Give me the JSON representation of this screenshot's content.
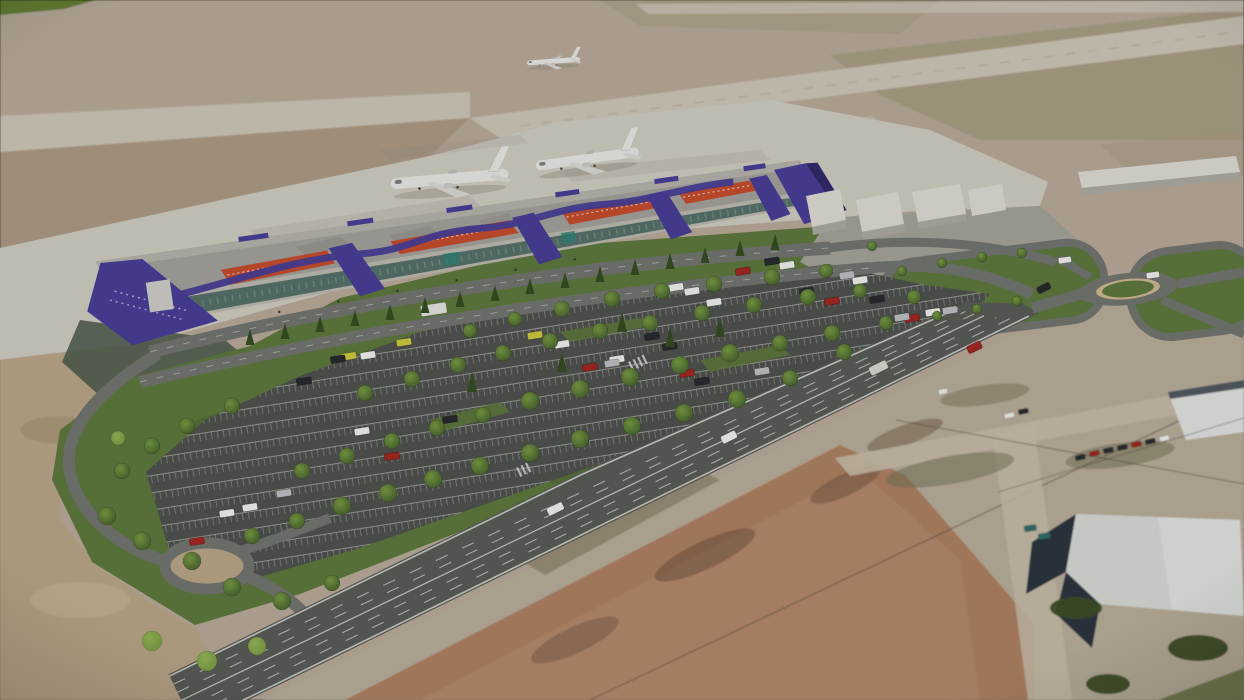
{
  "image": {
    "kind": "3D architectural aerial rendering",
    "subject": "Aerial rendering of a regional airport passenger terminal with landscaped parking lot, access roads, two roundabouts, runways with three aircraft, a diagonal multi-lane highway, and photographic dirt fields and warehouses in the foreground",
    "no_visible_text": true
  },
  "scene": {
    "aircraft_count": 3,
    "aircraft": [
      "airliner taxiing on apron west",
      "airliner taxiing on apron east",
      "small aircraft on far runway"
    ],
    "terminal": "long low terminal with gray roof, slanted purple pylons, wavy purple canopy ribbon and orange-red facade sign bands",
    "roundabout_count": 2,
    "parking": "tree-lined surface parking with white stall markings and scattered cars",
    "highway": "divided multi-lane road crossing the foreground diagonally toward a roundabout",
    "surroundings": "photographic context of bare dirt fields and industrial warehouses with white roofs"
  },
  "colors": {
    "airfield": "#b1a494",
    "green_strip": "#5e7c33",
    "airfield_olive": "#958e6e",
    "airfield_dirt": "#a5947f",
    "runway": "#c6bfb1",
    "runway_pad": "#beb5a5",
    "apron": "#c8c4ba",
    "roof": "#9d9b95",
    "roof_light": "#aeaca5",
    "purple": "#453b91",
    "purple_dark": "#2f2868",
    "orange": "#bf492c",
    "glass": "#41605a",
    "wall_light": "#b6b3aa",
    "white_bldg": "#d5d3cb",
    "bldg_side": "#a6a49c",
    "lawn": "#5a7339",
    "lawn_dark": "#475f2c",
    "tree": "#3e592a",
    "tree_light": "#74953f",
    "tree_dark": "#31491f",
    "park_lot": "#4c4e4b",
    "stall_white": "#d8dad4",
    "road": "#6e706c",
    "highway": "#565854",
    "lane_white": "#d3d5cf",
    "dirt_bl": "#b3a083",
    "dirt_field": "#a87c5f",
    "dirt_dark": "#5f4532",
    "photo_base": "#b2a794",
    "photo_road": "#c0b6a3",
    "scrub": "#6c6c4f",
    "navy": "#2b333d",
    "white_roof": "#d9dbd7",
    "plane_body": "#dfdfdb",
    "plane_shadow": "#8b8679",
    "car_white": "#e7e8e5",
    "car_dark": "#26292d",
    "car_red": "#9c241f",
    "car_silver": "#b6b9bc",
    "car_yellow": "#c6c13c",
    "car_teal": "#2f6b66",
    "wire": "#464135"
  }
}
